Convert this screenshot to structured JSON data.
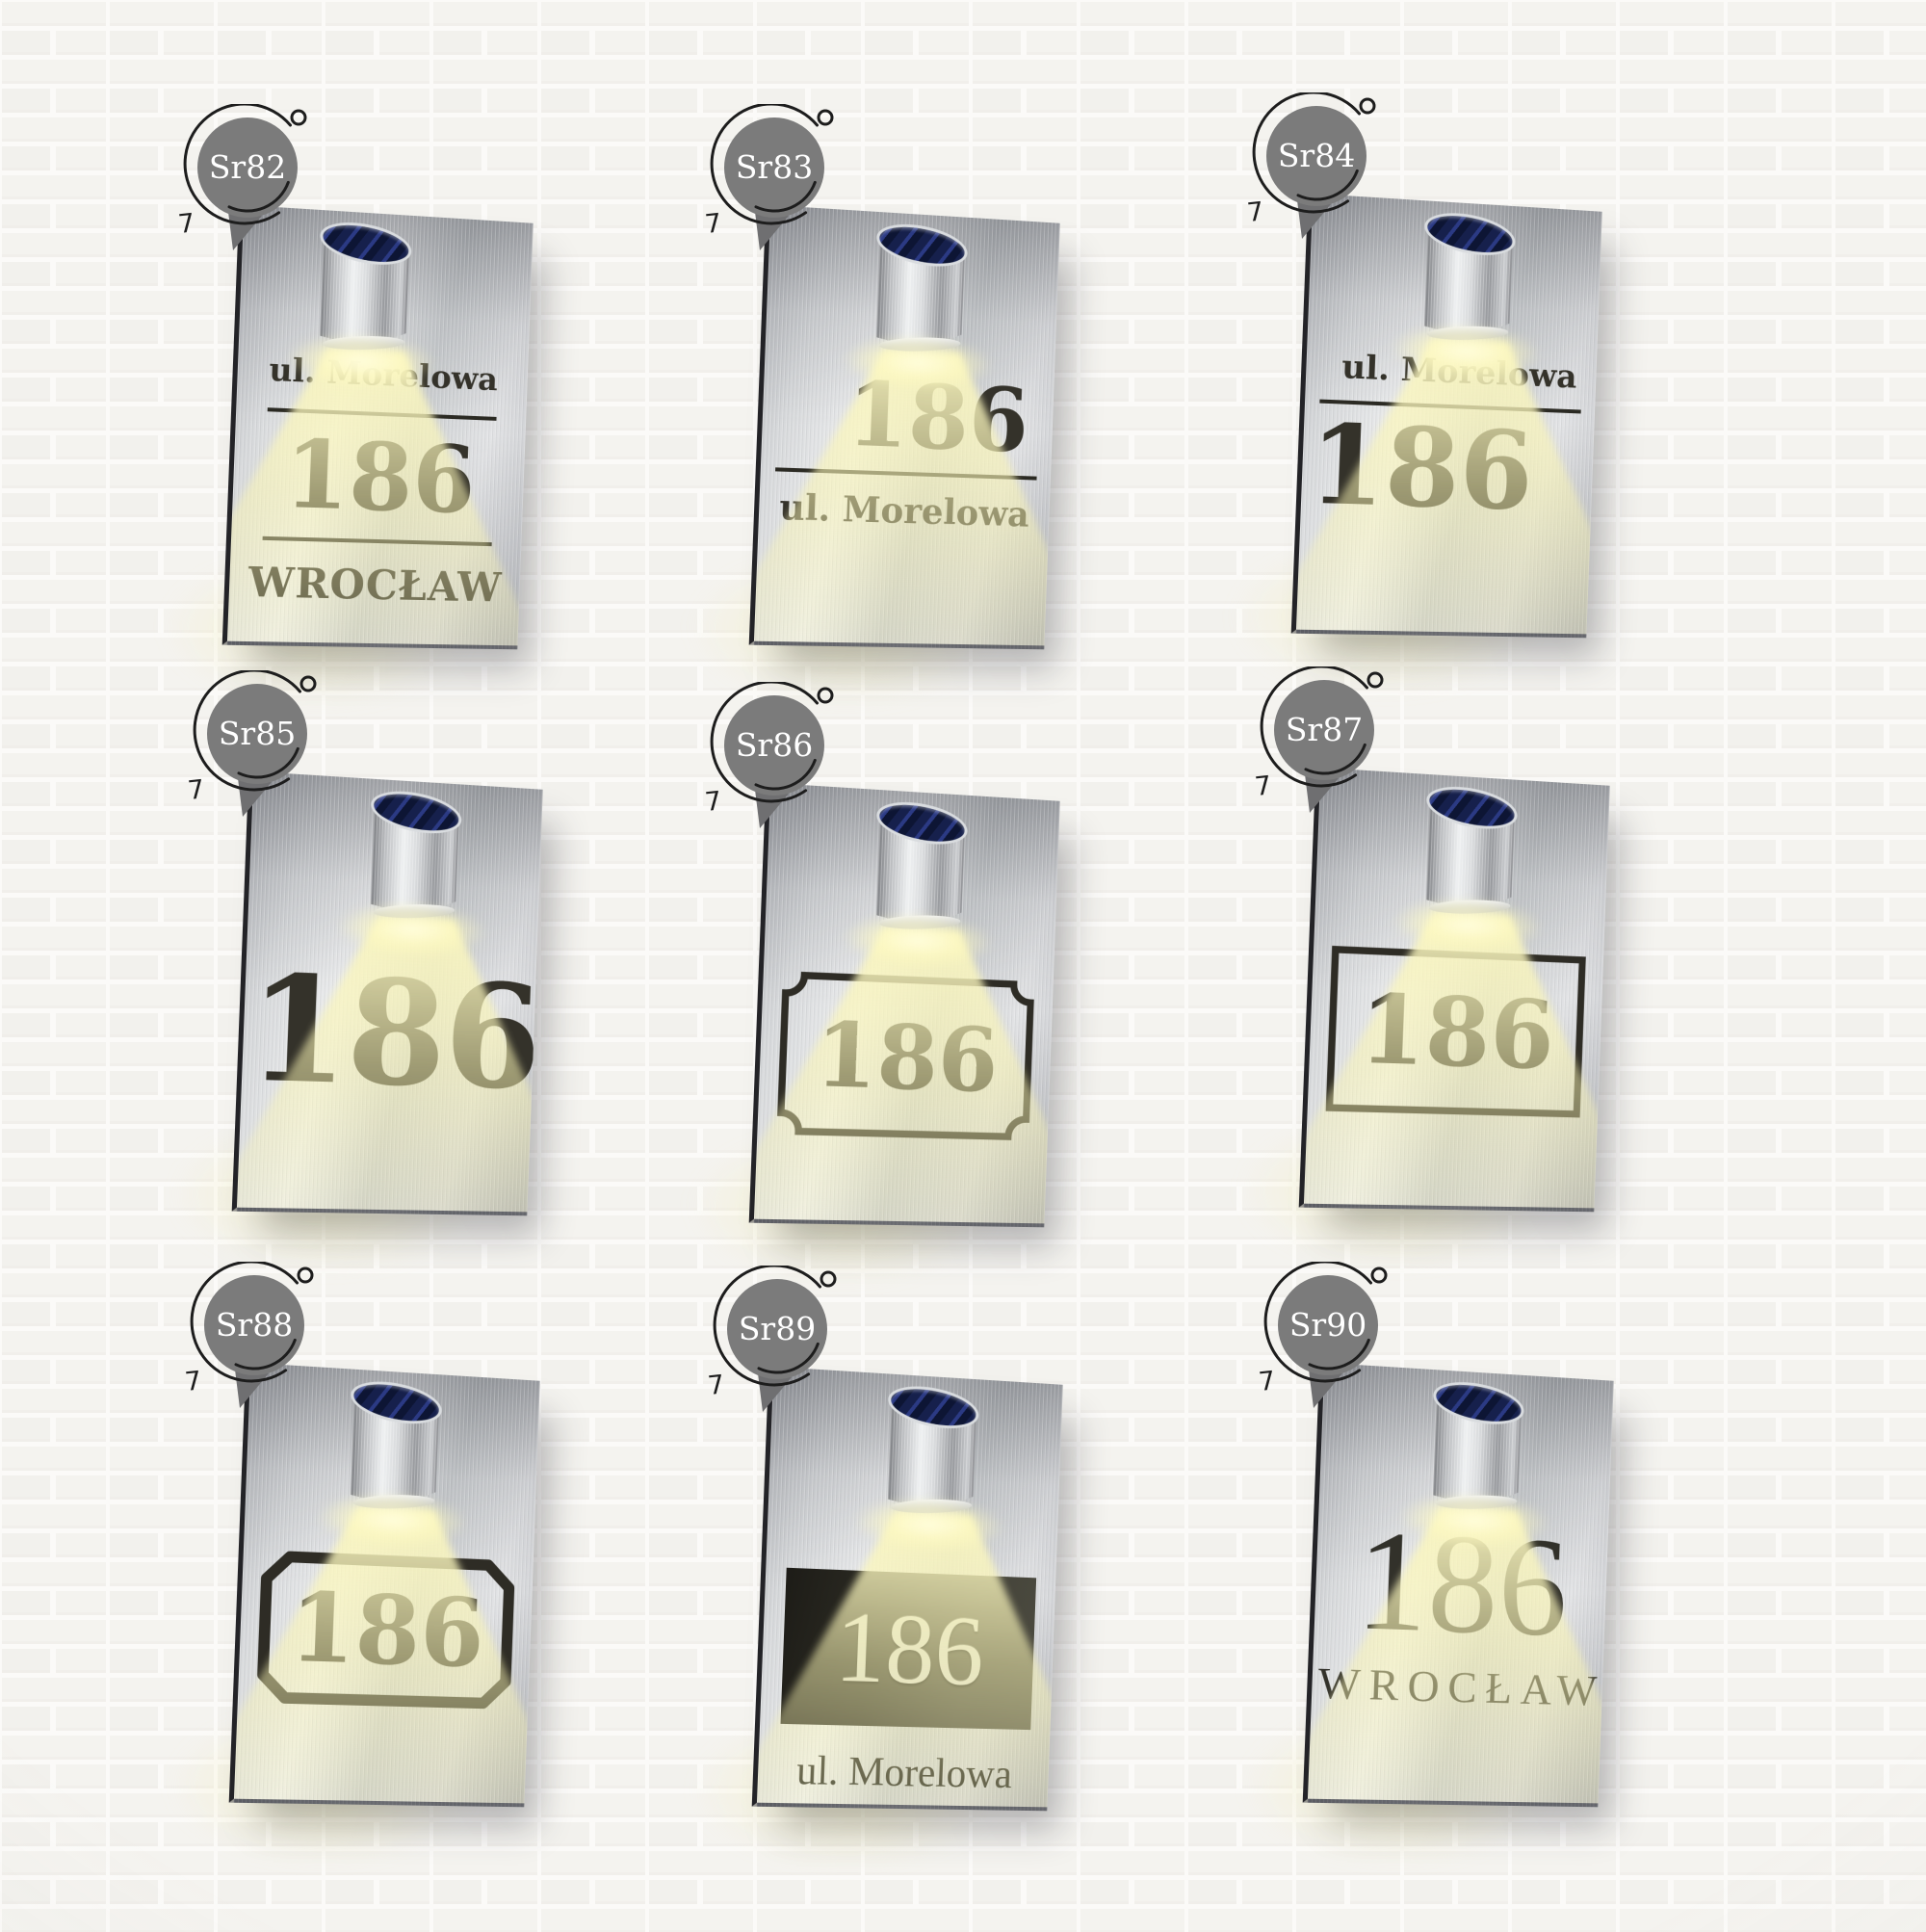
{
  "wall": {
    "brick": "#f4f3ef",
    "brick_alt": "#f1f0ec",
    "mortar": "#fbfaf8"
  },
  "palette": {
    "badge_bg": "#7b7b7b",
    "badge_text": "#ffffff",
    "plaque_text": "#34322a",
    "beam_yellow": "#f8f3b8",
    "solar_panel_navy": "#16204c",
    "steel_light": "#edeeef",
    "steel_dark": "#b4b6ba"
  },
  "decor": {
    "badge_scribble_mark": "7"
  },
  "cards": [
    {
      "badge": "Sr82",
      "street": "ul. Morelowa",
      "number": "186",
      "city": "WROCŁAW"
    },
    {
      "badge": "Sr83",
      "number": "186",
      "street": "ul. Morelowa"
    },
    {
      "badge": "Sr84",
      "street": "ul. Morelowa",
      "number": "186"
    },
    {
      "badge": "Sr85",
      "number": "186"
    },
    {
      "badge": "Sr86",
      "number": "186"
    },
    {
      "badge": "Sr87",
      "number": "186"
    },
    {
      "badge": "Sr88",
      "number": "186"
    },
    {
      "badge": "Sr89",
      "number": "186",
      "street": "ul. Morelowa"
    },
    {
      "badge": "Sr90",
      "number": "186",
      "city": "WROCŁAW"
    }
  ]
}
